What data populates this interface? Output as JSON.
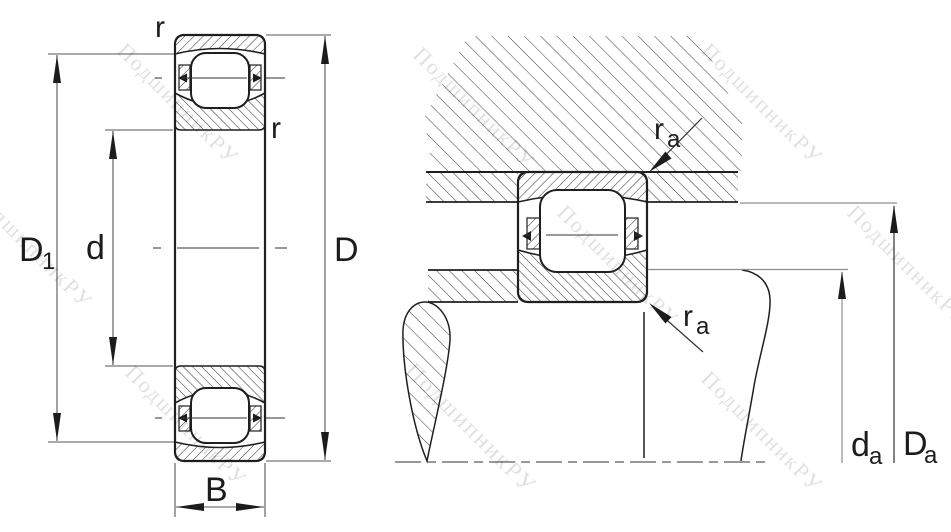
{
  "drawing": {
    "type": "bearing-mounting-diagram",
    "views": [
      "bearing-cross-section",
      "shaft-and-housing-abutment"
    ]
  },
  "watermark": {
    "text": "ПодшипникРУ"
  },
  "left_view": {
    "labels": {
      "chamfer_top": "r",
      "chamfer_side": "r",
      "land_diameter_main": "D",
      "land_diameter_sub": "1",
      "bore_diameter": "d",
      "outside_diameter": "D",
      "width": "B"
    }
  },
  "right_view": {
    "labels": {
      "housing_fillet_main": "r",
      "housing_fillet_sub": "a",
      "shaft_fillet_main": "r",
      "shaft_fillet_sub": "a",
      "shaft_abutment_main": "d",
      "shaft_abutment_sub": "a",
      "housing_abutment_main": "D",
      "housing_abutment_sub": "a"
    }
  },
  "colors": {
    "outline": "#1f1f1f",
    "hatch": "#3c3c3c",
    "dimension_line": "#555555",
    "light_extension_line": "#8f8f8f",
    "watermark": "#000000"
  }
}
